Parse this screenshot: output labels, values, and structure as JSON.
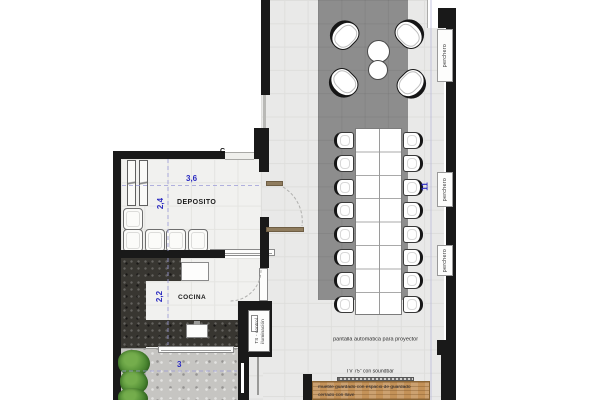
{
  "title": "floor-plan-meeting-room",
  "rooms": {
    "deposito": {
      "name": "DEPOSITO"
    },
    "cocina": {
      "name": "COCINA"
    }
  },
  "dimensions": {
    "deposito_width": "3,6",
    "deposito_depth": "2,4",
    "cocina_depth": "2,2",
    "terrace_width": "3",
    "hall_length": "11"
  },
  "labels": {
    "perchero": "perchero",
    "section_marker": "C",
    "ts_control_line1": "TS - control",
    "ts_control_line2": "iluminación",
    "projector_screen": "pantalla automatica para proyector",
    "tv": "TV 75\" con soundbar",
    "cabinet_line1": "mueble guardado con espacio de guardado",
    "cabinet_line2": "cerrado con llave"
  },
  "furniture": {
    "conference_seats_per_side": 8,
    "lounge_chairs": 4,
    "lounge_tables": 2,
    "stacked_chairs_row": 4,
    "perchero_count": 3
  },
  "colors": {
    "wall": "#191919",
    "carpet": "#8d8d8d",
    "floor": "#e9e9e8",
    "dimension_blue": "#2a2ac0",
    "counter_dark": "#383631",
    "wood": "#c49258",
    "plant_green": "#4e8a33",
    "terrace_concrete": "#c6c5c2"
  }
}
